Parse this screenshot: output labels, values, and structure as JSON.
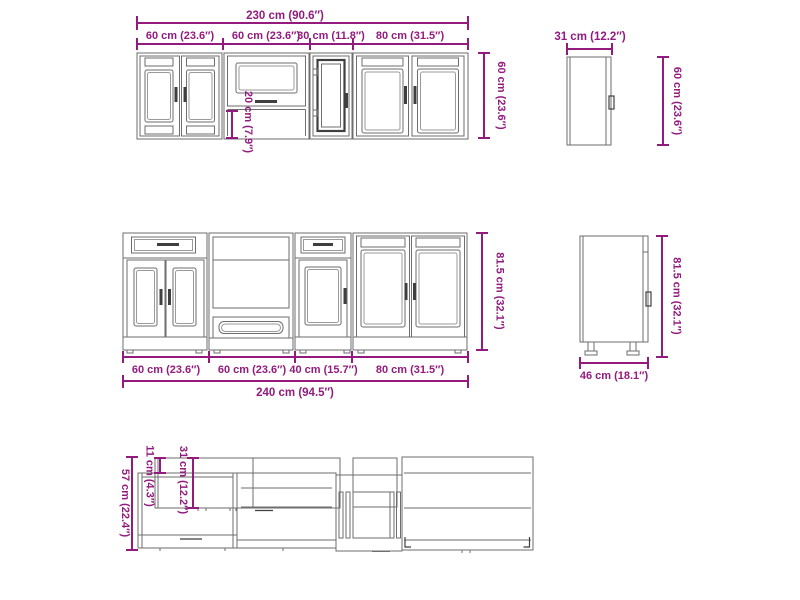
{
  "title": "Kitchen cabinet set dimension diagram",
  "colors": {
    "dimension": "#931b7e",
    "line": "#6e6e6e",
    "line_dark": "#3f3f3f",
    "background": "#ffffff"
  },
  "wall_front_view": {
    "total_width_label": "230 cm (90.6″)",
    "segment_labels": [
      "60 cm (23.6″)",
      "60 cm (23.6″)",
      "30 cm (11.8″)",
      "80 cm (31.5″)"
    ],
    "height_label": "60 cm (23.6″)",
    "open_section_height_label": "20 cm (7.9″)"
  },
  "wall_side_view": {
    "depth_label": "31 cm (12.2″)",
    "height_label": "60 cm (23.6″)"
  },
  "base_front_view": {
    "segment_labels": [
      "60 cm (23.6″)",
      "60 cm (23.6″)",
      "40 cm (15.7″)",
      "80 cm (31.5″)"
    ],
    "total_width_label": "240 cm (94.5″)",
    "height_label": "81.5 cm (32.1″)"
  },
  "base_side_view": {
    "depth_label": "46 cm (18.1″)",
    "height_label": "81.5 cm (32.1″)"
  },
  "top_plan_view": {
    "total_depth_label": "57 cm (22.4″)",
    "overhang_depth_label": "11 cm (4.3″)",
    "upper_depth_label": "31 cm (12.2″)"
  }
}
